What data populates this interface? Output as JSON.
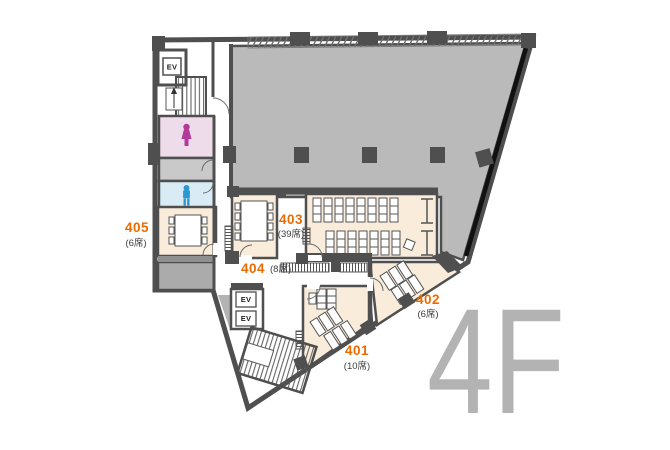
{
  "floor_plan": {
    "floor_label": "4F",
    "rooms": {
      "r401": {
        "number": "401",
        "capacity": "(10席)"
      },
      "r402": {
        "number": "402",
        "capacity": "(6席)"
      },
      "r403": {
        "number": "403",
        "capacity": "(39席)"
      },
      "r404": {
        "number": "404",
        "capacity": "(8席)"
      },
      "r405": {
        "number": "405",
        "capacity": "(6席)"
      }
    },
    "elevator": {
      "label": "EV"
    },
    "icons": {
      "female_restroom": "female-figure-icon",
      "male_restroom": "male-figure-icon"
    },
    "colors": {
      "accent_orange": "#ec6b00",
      "tenant_gray": "#bababa",
      "room_beige": "#f9ecdb",
      "female_pink": "#eedcea",
      "male_blue": "#d9ecf5",
      "wall_dark": "#4f4f4f",
      "floor_label_gray": "#b3b3b3"
    }
  }
}
